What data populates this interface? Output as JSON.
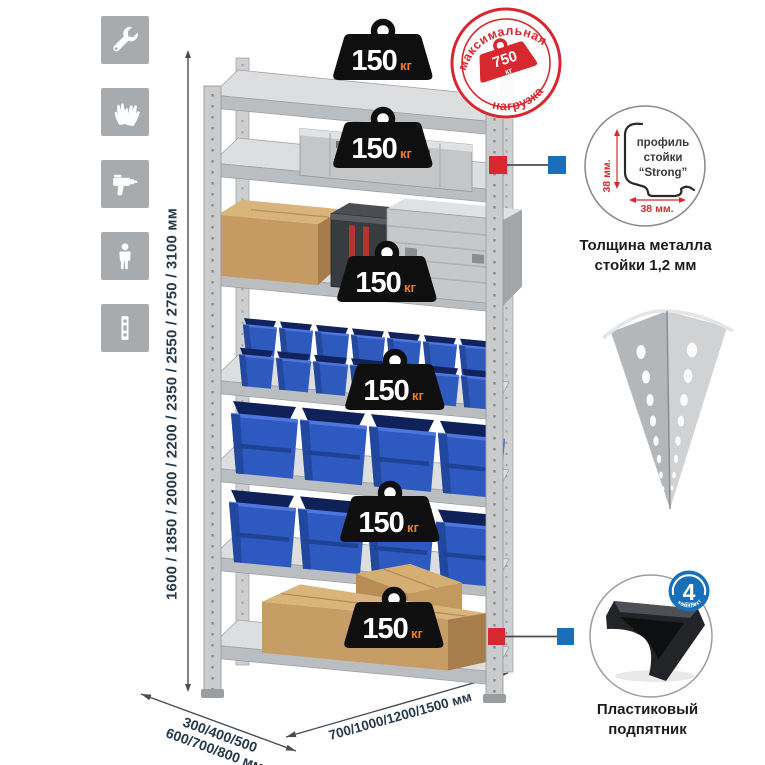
{
  "features": {
    "icons": [
      {
        "name": "wrench-icon"
      },
      {
        "name": "gloves-icon"
      },
      {
        "name": "drill-icon"
      },
      {
        "name": "person-icon"
      },
      {
        "name": "profile-strip-icon"
      }
    ]
  },
  "dimensions": {
    "heights_label": "1600 / 1850 / 2000 / 2200 / 2350 / 2550 / 2750 / 3100 мм",
    "depth_label_line1": "300/400/500",
    "depth_label_line2": "600/700/800 мм",
    "width_label": "700/1000/1200/1500 мм"
  },
  "rack": {
    "shelf_count": 7,
    "badge_count": 6,
    "shelf_load_value": "150",
    "shelf_load_unit": "кг"
  },
  "stamp": {
    "arc_top": "максимальная",
    "arc_bottom": "нагрузка",
    "value": "750",
    "unit": "кг"
  },
  "profile_detail": {
    "line1": "профиль",
    "line2": "стойки",
    "line3": "“Strong”",
    "dim_v": "38 мм.",
    "dim_h": "38 мм.",
    "caption_line1": "Толщина металла",
    "caption_line2": "стойки 1,2 мм"
  },
  "foot": {
    "caption_line1": "Пластиковый",
    "caption_line2": "подпятник",
    "count": "4",
    "count_small_text": "штуки",
    "arc_text": "в комплекте"
  },
  "colors": {
    "accent_red": "#d7282f",
    "accent_blue": "#1a70b8",
    "bin_blue": "#2d59c0",
    "dim_text": "#25394a",
    "badge_unit_orange": "#ed7d23",
    "metal_gray": "#c9cbcd",
    "cardboard": "#c79e66"
  }
}
